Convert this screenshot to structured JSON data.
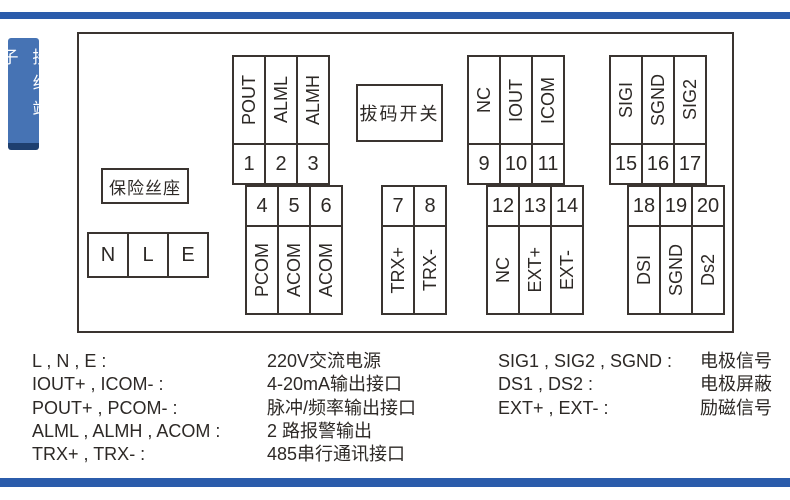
{
  "page": {
    "side_tab": "接线端子"
  },
  "diagram": {
    "fuse_label": "保险丝座",
    "dip_label": "拔码开关",
    "power_cells": [
      "N",
      "L",
      "E"
    ],
    "blocks": [
      {
        "id": "pulse-alarm-upper",
        "label_side": "top",
        "labels": [
          "POUT",
          "ALML",
          "ALMH"
        ],
        "numbers": [
          "1",
          "2",
          "3"
        ]
      },
      {
        "id": "pulse-alarm-lower",
        "label_side": "bottom",
        "labels": [
          "PCOM",
          "ACOM",
          "ACOM"
        ],
        "numbers": [
          "4",
          "5",
          "6"
        ]
      },
      {
        "id": "rs485-comm",
        "label_side": "bottom",
        "labels": [
          "TRX+",
          "TRX-"
        ],
        "numbers": [
          "7",
          "8"
        ]
      },
      {
        "id": "current-output",
        "label_side": "top",
        "labels": [
          "NC",
          "IOUT",
          "ICOM"
        ],
        "numbers": [
          "9",
          "10",
          "11"
        ]
      },
      {
        "id": "excitation",
        "label_side": "bottom",
        "labels": [
          "NC",
          "EXT+",
          "EXT-"
        ],
        "numbers": [
          "12",
          "13",
          "14"
        ]
      },
      {
        "id": "electrode-signal",
        "label_side": "top",
        "labels": [
          "SIGI",
          "SGND",
          "SIG2"
        ],
        "numbers": [
          "15",
          "16",
          "17"
        ]
      },
      {
        "id": "electrode-shield",
        "label_side": "bottom",
        "labels": [
          "DSI",
          "SGND",
          "Ds2"
        ],
        "numbers": [
          "18",
          "19",
          "20"
        ]
      }
    ]
  },
  "legend": {
    "left": [
      {
        "term": "L , N , E :",
        "desc": "220V交流电源"
      },
      {
        "term": "IOUT+ , ICOM- :",
        "desc": "4-20mA输出接口"
      },
      {
        "term": "POUT+ , PCOM- :",
        "desc": "脉冲/频率输出接口"
      },
      {
        "term": "ALML , ALMH , ACOM :",
        "desc": "2 路报警输出"
      },
      {
        "term": "TRX+ , TRX- :",
        "desc": "485串行通讯接口"
      }
    ],
    "right": [
      {
        "term": "SIG1 , SIG2 , SGND :",
        "desc": "电极信号"
      },
      {
        "term": "DS1 , DS2 :",
        "desc": "电极屏蔽"
      },
      {
        "term": "EXT+ , EXT- :",
        "desc": "励磁信号"
      }
    ]
  },
  "colors": {
    "accent_blue": "#2b5cab",
    "tab_blue": "#4673b4",
    "tab_shadow": "#1e3f6f",
    "diagram_line": "#3a3430",
    "text": "#2d2926"
  }
}
